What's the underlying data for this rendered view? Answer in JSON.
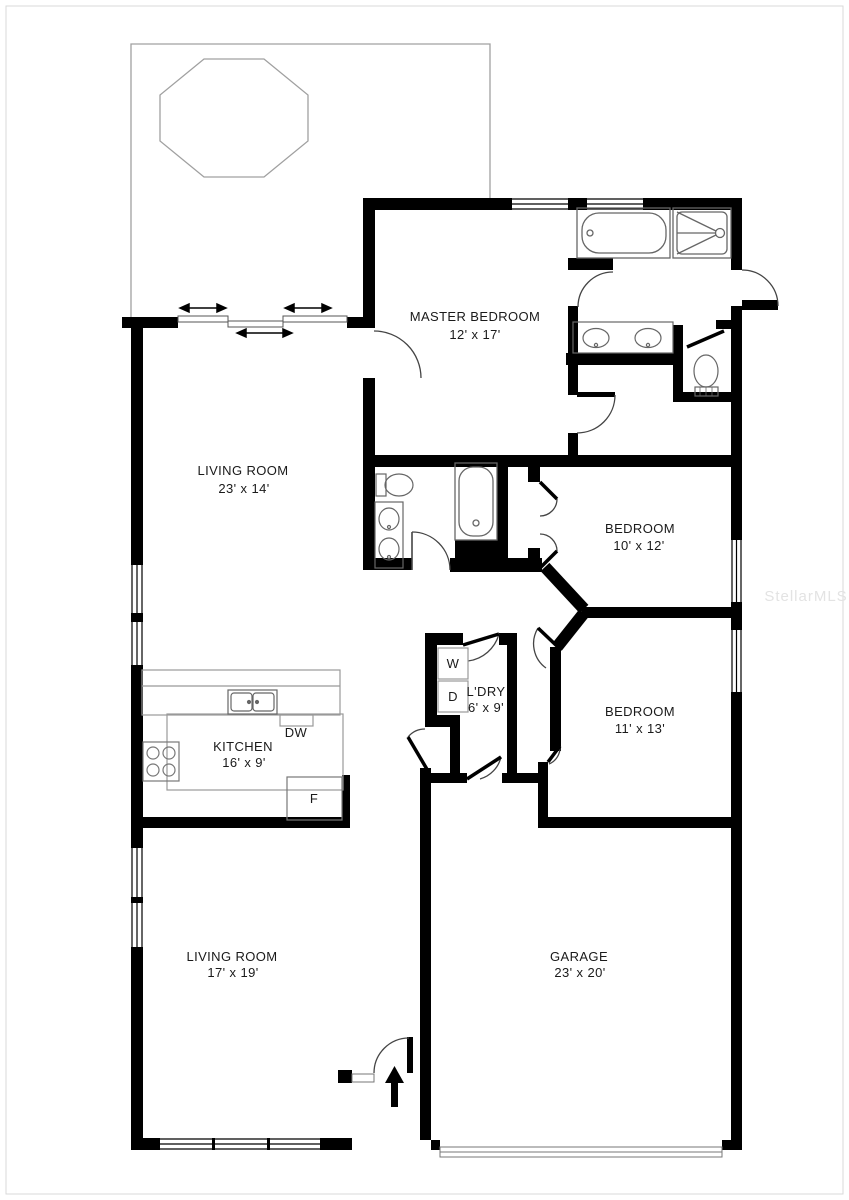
{
  "plan": {
    "watermark": "StellarMLS",
    "rooms": [
      {
        "name": "MASTER BEDROOM",
        "dims": "12' x 17'"
      },
      {
        "name": "LIVING ROOM",
        "dims": "23' x 14'"
      },
      {
        "name": "BEDROOM",
        "dims": "10' x 12'"
      },
      {
        "name": "BEDROOM",
        "dims": "11' x 13'"
      },
      {
        "name": "L'DRY",
        "dims": "6' x 9'"
      },
      {
        "name": "KITCHEN",
        "dims": "16' x 9'"
      },
      {
        "name": "LIVING ROOM",
        "dims": "17' x 19'"
      },
      {
        "name": "GARAGE",
        "dims": "23' x 20'"
      }
    ],
    "appliances": {
      "washer": "W",
      "dryer": "D",
      "dishwasher": "DW",
      "refrigerator": "F"
    },
    "colors": {
      "wall": "#000000",
      "fixture_line": "#666666",
      "counter_line": "#999999",
      "watermark": "#e3e3e3",
      "background": "#ffffff"
    }
  }
}
